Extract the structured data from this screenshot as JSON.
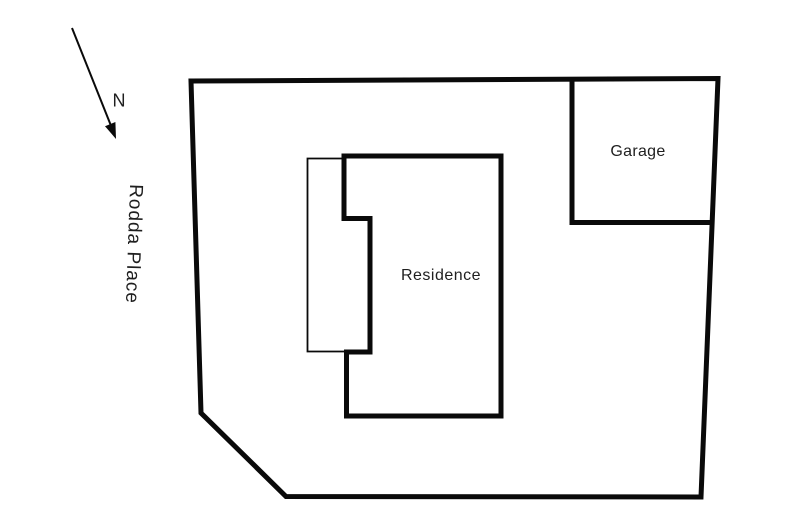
{
  "colors": {
    "line": "#0a0a0a",
    "text": "#1f1f1f",
    "background": "#ffffff"
  },
  "compass": {
    "icon": "north-arrow-icon",
    "label": "N"
  },
  "street": {
    "name": "Rodda Place"
  },
  "buildings": {
    "residence": {
      "label": "Residence"
    },
    "garage": {
      "label": "Garage"
    }
  }
}
